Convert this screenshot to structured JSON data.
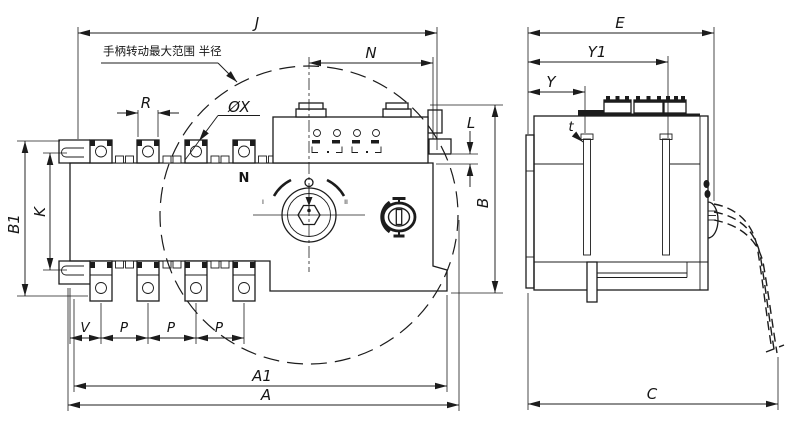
{
  "annotation": {
    "handle_range": "手柄转动最大范围 半径"
  },
  "labels": {
    "dim_j": "J",
    "dim_n": "N",
    "dim_r": "R",
    "dim_phi_x": "ØX",
    "dim_l": "L",
    "dim_b": "B",
    "dim_b1": "B1",
    "dim_k": "K",
    "dim_v": "V",
    "dim_p": "P",
    "dim_a1": "A1",
    "dim_a": "A",
    "dim_e": "E",
    "dim_y1": "Y1",
    "dim_y": "Y",
    "dim_t": "t",
    "dim_c": "C",
    "neutral_pole": "N",
    "handle_pos_left": "I",
    "handle_pos_right": "II"
  },
  "colors": {
    "line": "#1c1c1c",
    "background": "#ffffff"
  }
}
